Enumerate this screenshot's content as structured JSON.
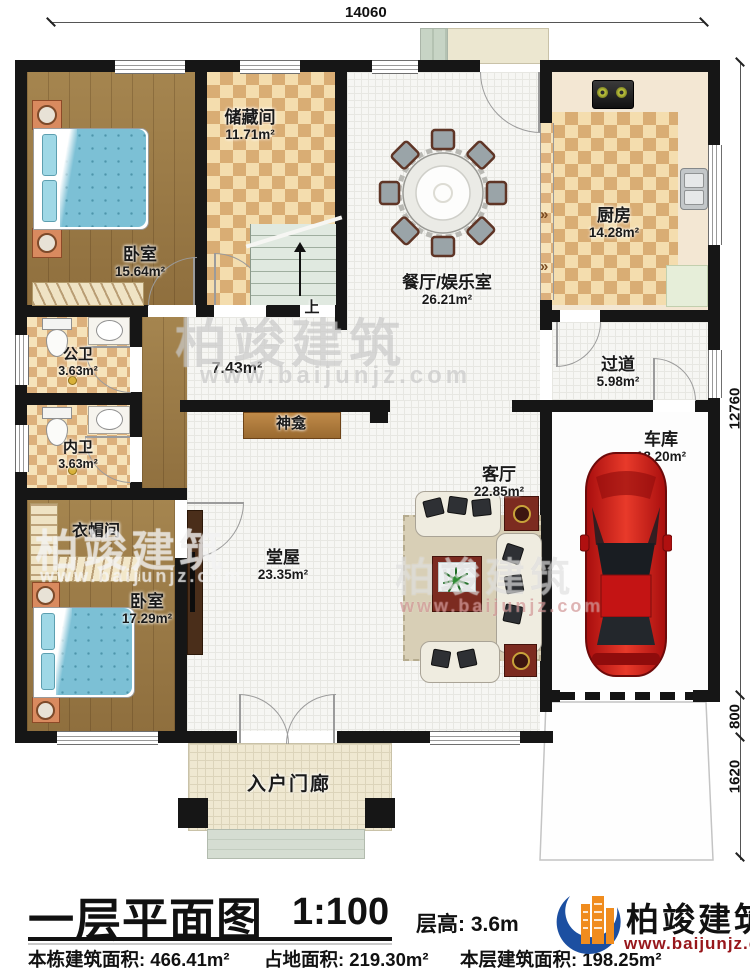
{
  "dimensions": {
    "top": "14060",
    "right_total": "12760",
    "right_mid": "800",
    "right_bottom": "1620"
  },
  "rooms": {
    "bedroom_top": {
      "name": "卧室",
      "area": "15.64m²"
    },
    "storage": {
      "name": "储藏间",
      "area": "11.71m²"
    },
    "dining": {
      "name": "餐厅/娱乐室",
      "area": "26.21m²"
    },
    "kitchen": {
      "name": "厨房",
      "area": "14.28m²"
    },
    "public_bath": {
      "name": "公卫",
      "area": "3.63m²"
    },
    "inner_bath": {
      "name": "内卫",
      "area": "3.63m²"
    },
    "corridor": {
      "area": "7.43m²"
    },
    "passage": {
      "name": "过道",
      "area": "5.98m²"
    },
    "main_hall": {
      "name": "堂屋",
      "area": "23.35m²"
    },
    "living": {
      "name": "客厅",
      "area": "22.85m²"
    },
    "garage": {
      "name": "车库",
      "area": "18.20m²"
    },
    "cloakroom": {
      "name": "衣帽间"
    },
    "bedroom_bottom": {
      "name": "卧室",
      "area": "17.29m²"
    },
    "porch": {
      "name": "入户门廊"
    },
    "shrine": {
      "name": "神龛"
    },
    "stairs": {
      "up_label": "上"
    }
  },
  "footer": {
    "title": "一层平面图",
    "scale": "1:100",
    "floor_height": "层高: 3.6m",
    "building_area": "本栋建筑面积: 466.41m²",
    "land_area": "占地面积: 219.30m²",
    "floor_area": "本层建筑面积: 198.25m²"
  },
  "brand": {
    "name": "柏竣建筑",
    "website": "www.baijunjz.com"
  },
  "watermark": {
    "name": "柏竣建筑",
    "website": "www.baijunjz.com"
  },
  "colors": {
    "wall": "#161616",
    "brand_blue": "#1c4fa1",
    "brand_orange": "#f08c1e",
    "brand_red": "#97161b",
    "wood": "#9a7a4a",
    "checker_dark": "#d9ad74",
    "checker_light": "#f4ddae",
    "car_red": "#c41414"
  }
}
